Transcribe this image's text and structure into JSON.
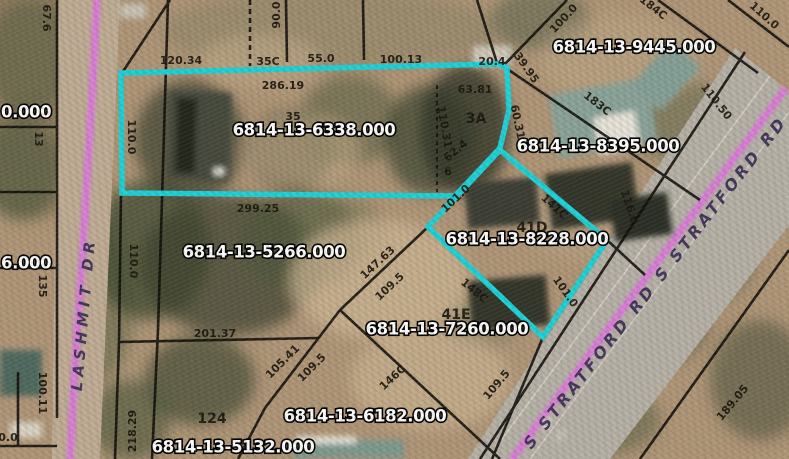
{
  "map": {
    "type": "gis-parcel-map",
    "highlighted_parcel_ids": [
      "6814-13-6338.000",
      "6814-13-8228.000"
    ],
    "colors": {
      "highlight_cyan": "#1dd2d8",
      "road_centerline_pink": "#da7fd8",
      "boundary_black": "#0d0c0a",
      "parcel_label_fill": "#ffffff",
      "parcel_label_outline": "#000000",
      "road_text": "#42355c",
      "terrain_tan": "#b09678"
    },
    "parcel_labels": [
      {
        "text": "6814-13-6338.000",
        "x": 314,
        "y": 131
      },
      {
        "text": "6814-13-9445.000",
        "x": 634,
        "y": 48
      },
      {
        "text": "6814-13-8395.000",
        "x": 598,
        "y": 147
      },
      {
        "text": "6814-13-8228.000",
        "x": 527,
        "y": 240
      },
      {
        "text": "6814-13-5266.000",
        "x": 264,
        "y": 253
      },
      {
        "text": "6814-13-7260.000",
        "x": 447,
        "y": 330
      },
      {
        "text": "6814-13-6182.000",
        "x": 365,
        "y": 417
      },
      {
        "text": "6814-13-5132.000",
        "x": 233,
        "y": 448
      },
      {
        "text": "0.000",
        "x": 1,
        "y": 113,
        "anchor": "start"
      },
      {
        "text": "6.000",
        "x": 1,
        "y": 264,
        "anchor": "start"
      }
    ],
    "road_labels": [
      {
        "text": "LASHMIT DR",
        "x": 84,
        "y": 314,
        "rot": -85,
        "size": 15,
        "spacing": 5
      },
      {
        "text": "S STRATFORD RD S STRATFORD RD",
        "x": 656,
        "y": 283,
        "rot": -52,
        "size": 16,
        "spacing": 3.5
      }
    ],
    "dimension_labels": [
      {
        "text": "67.6",
        "x": 46,
        "y": 18,
        "rot": 90
      },
      {
        "text": "120.34",
        "x": 181,
        "y": 61,
        "rot": 0
      },
      {
        "text": "35C",
        "x": 268,
        "y": 62,
        "rot": 0
      },
      {
        "text": "55.0",
        "x": 321,
        "y": 59,
        "rot": 0
      },
      {
        "text": "100.13",
        "x": 401,
        "y": 60,
        "rot": 0
      },
      {
        "text": "20.4",
        "x": 492,
        "y": 62,
        "rot": 0
      },
      {
        "text": "90.0",
        "x": 277,
        "y": 15,
        "rot": -90
      },
      {
        "text": "286.19",
        "x": 283,
        "y": 86,
        "rot": 0
      },
      {
        "text": "110.0",
        "x": 131,
        "y": 137,
        "rot": 90
      },
      {
        "text": "299.25",
        "x": 258,
        "y": 209,
        "rot": 0
      },
      {
        "text": "110.0",
        "x": 133,
        "y": 261,
        "rot": 90
      },
      {
        "text": "110.31",
        "x": 444,
        "y": 127,
        "rot": 80
      },
      {
        "text": "63.81",
        "x": 475,
        "y": 90,
        "rot": 0
      },
      {
        "text": "3A",
        "x": 476,
        "y": 119,
        "rot": 0,
        "size": 14
      },
      {
        "text": "62.4",
        "x": 456,
        "y": 151,
        "rot": -40
      },
      {
        "text": "6",
        "x": 448,
        "y": 172,
        "rot": 0
      },
      {
        "text": "60.31",
        "x": 517,
        "y": 122,
        "rot": 78
      },
      {
        "text": "100.0",
        "x": 564,
        "y": 19,
        "rot": -47
      },
      {
        "text": "39.95",
        "x": 526,
        "y": 68,
        "rot": 55
      },
      {
        "text": "184C",
        "x": 653,
        "y": 8,
        "rot": 38
      },
      {
        "text": "110.0",
        "x": 764,
        "y": 16,
        "rot": 42
      },
      {
        "text": "183C",
        "x": 597,
        "y": 104,
        "rot": 38
      },
      {
        "text": "110.50",
        "x": 716,
        "y": 102,
        "rot": 52
      },
      {
        "text": "116.0",
        "x": 629,
        "y": 207,
        "rot": 72
      },
      {
        "text": "101.0",
        "x": 456,
        "y": 199,
        "rot": -43
      },
      {
        "text": "141C",
        "x": 554,
        "y": 207,
        "rot": 42
      },
      {
        "text": "41D",
        "x": 532,
        "y": 228,
        "rot": 0,
        "size": 14
      },
      {
        "text": "148C",
        "x": 474,
        "y": 291,
        "rot": 40
      },
      {
        "text": "101.0",
        "x": 565,
        "y": 292,
        "rot": 55
      },
      {
        "text": "41E",
        "x": 456,
        "y": 315,
        "rot": 0,
        "size": 14
      },
      {
        "text": "147.63",
        "x": 378,
        "y": 263,
        "rot": -43
      },
      {
        "text": "109.5",
        "x": 390,
        "y": 287,
        "rot": -43
      },
      {
        "text": "105.41",
        "x": 283,
        "y": 362,
        "rot": -45
      },
      {
        "text": "109.5",
        "x": 312,
        "y": 368,
        "rot": -45
      },
      {
        "text": "146C",
        "x": 393,
        "y": 378,
        "rot": -43
      },
      {
        "text": "109.5",
        "x": 497,
        "y": 385,
        "rot": -50
      },
      {
        "text": "189.05",
        "x": 733,
        "y": 403,
        "rot": -50
      },
      {
        "text": "201.37",
        "x": 215,
        "y": 334,
        "rot": 0
      },
      {
        "text": "124",
        "x": 212,
        "y": 419,
        "rot": 0,
        "size": 14
      },
      {
        "text": "100.11",
        "x": 42,
        "y": 393,
        "rot": 90
      },
      {
        "text": "218.29",
        "x": 133,
        "y": 431,
        "rot": -90
      },
      {
        "text": "0.0",
        "x": 8,
        "y": 438,
        "rot": 0
      },
      {
        "text": "13",
        "x": 38,
        "y": 139,
        "rot": 90
      },
      {
        "text": "135",
        "x": 42,
        "y": 286,
        "rot": 90
      },
      {
        "text": "35",
        "x": 293,
        "y": 117,
        "rot": 0
      }
    ]
  }
}
